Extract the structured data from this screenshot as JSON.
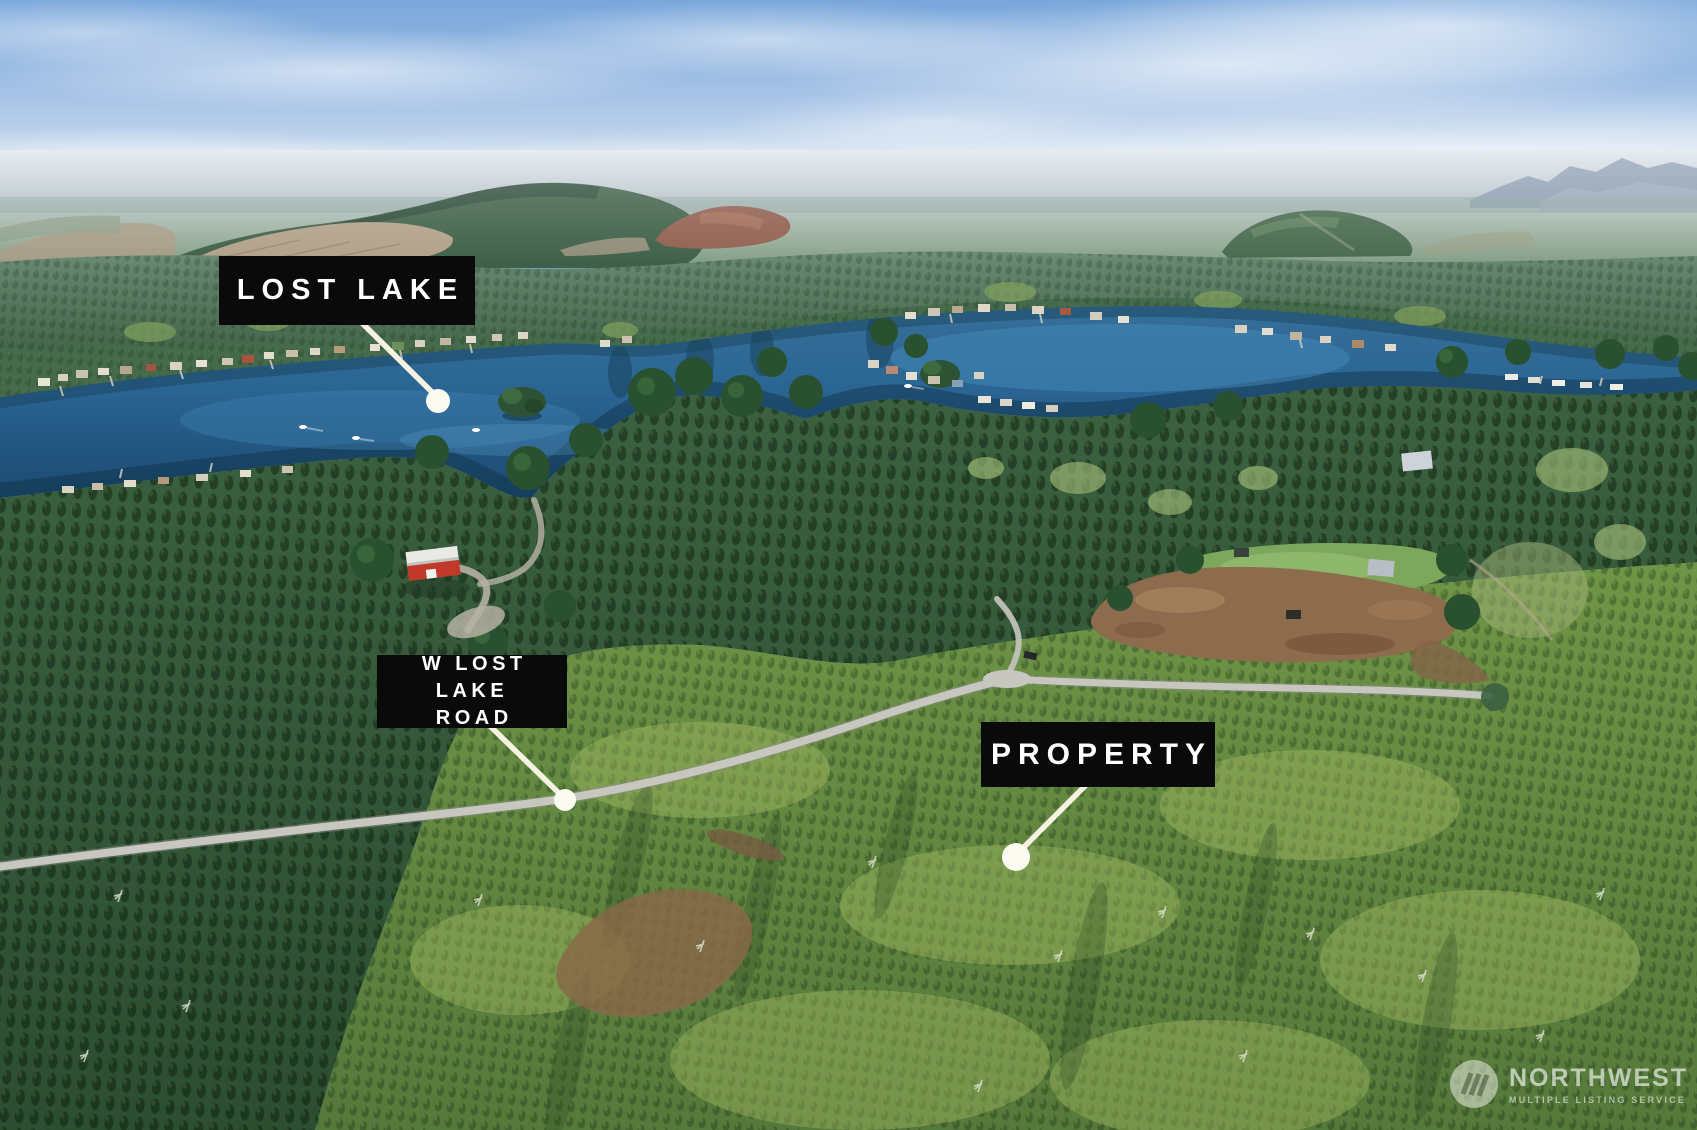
{
  "annotations": {
    "lake_label": "LOST LAKE",
    "road_label_line1": "W LOST LAKE",
    "road_label_line2": "ROAD",
    "property_label": "PROPERTY"
  },
  "watermark": {
    "brand": "NORTHWEST",
    "tagline": "MULTIPLE LISTING SERVICE"
  },
  "palette": {
    "label_background": "#0a0a0a",
    "label_text": "#ffffff",
    "leader_line": "#f6f2e2",
    "marker_dot": "#fcfbf2",
    "sky_blue": "#8fb4e0",
    "lake_water": "#2a6492",
    "mature_forest": "#2e5133",
    "young_plantation": "#6f9546",
    "clearcut_tan": "#b2a189",
    "dirt_brown": "#8d6b4d",
    "road_gray": "#c7c7c0"
  }
}
